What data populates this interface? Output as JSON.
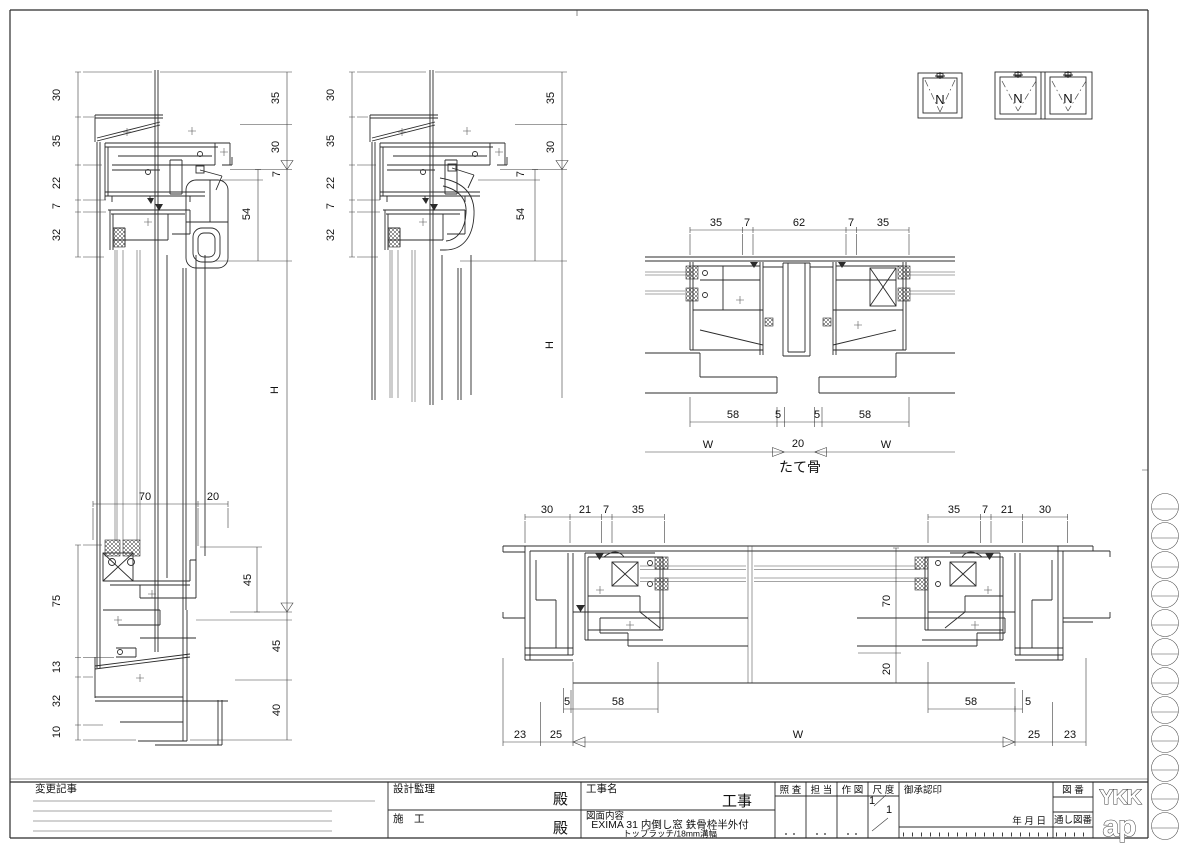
{
  "page": {
    "line_color": "#2b2b2b",
    "background": "#ffffff"
  },
  "elevation": {
    "n_single": "N",
    "n_left": "N",
    "n_right": "N"
  },
  "dims": {
    "a_left": [
      "30",
      "35",
      "22",
      "7",
      "32"
    ],
    "a_right": [
      "35",
      "30"
    ],
    "a_inner": [
      "7",
      "54"
    ],
    "a_h": "H",
    "a_glass": [
      "70",
      "20"
    ],
    "a_sill_left": [
      "75",
      "13",
      "32",
      "10"
    ],
    "a_sill_inner": "45",
    "a_sill_right": [
      "45",
      "40"
    ],
    "b_left": [
      "30",
      "35",
      "22",
      "7",
      "32"
    ],
    "b_right": [
      "35",
      "30"
    ],
    "b_inner": [
      "7",
      "54"
    ],
    "b_h": "H",
    "c_top": [
      "35",
      "7",
      "62",
      "7",
      "35"
    ],
    "c_bottom": [
      "58",
      "5",
      "5",
      "58"
    ],
    "c_w_left": "W",
    "c_20": "20",
    "c_w_right": "W",
    "c_label": "たて骨",
    "d_top_left": [
      "30",
      "21",
      "7",
      "35"
    ],
    "d_top_right": [
      "35",
      "7",
      "21",
      "30"
    ],
    "d_vert": [
      "70",
      "20"
    ],
    "d_bottom_left": [
      "5",
      "58"
    ],
    "d_bottom_right": [
      "58",
      "5"
    ],
    "d_chain_left": [
      "23",
      "25"
    ],
    "d_w": "W",
    "d_chain_right": [
      "25",
      "23"
    ]
  },
  "title_block": {
    "change_notes": "変更記事",
    "design_supervision": "設計監理",
    "dono_1": "殿",
    "construction": "施　工",
    "dono_2": "殿",
    "project_label": "工事名",
    "project_suffix": "工事",
    "content_label": "図面内容",
    "content_line1": "EXIMA 31 内倒し窓 鉄骨枠半外付",
    "content_line2": "トップラッチ/18mm溝幅",
    "check": "照 査",
    "in_charge": "担 当",
    "drafting": "作 図",
    "scale": "尺 度",
    "scale_num": "1",
    "scale_den": "1",
    "approval": "御承認印",
    "date": "年 月 日",
    "drawing_no": "図 番",
    "serial_no": "通し図番",
    "logo_top": "YKK",
    "logo_bottom": "ap"
  }
}
